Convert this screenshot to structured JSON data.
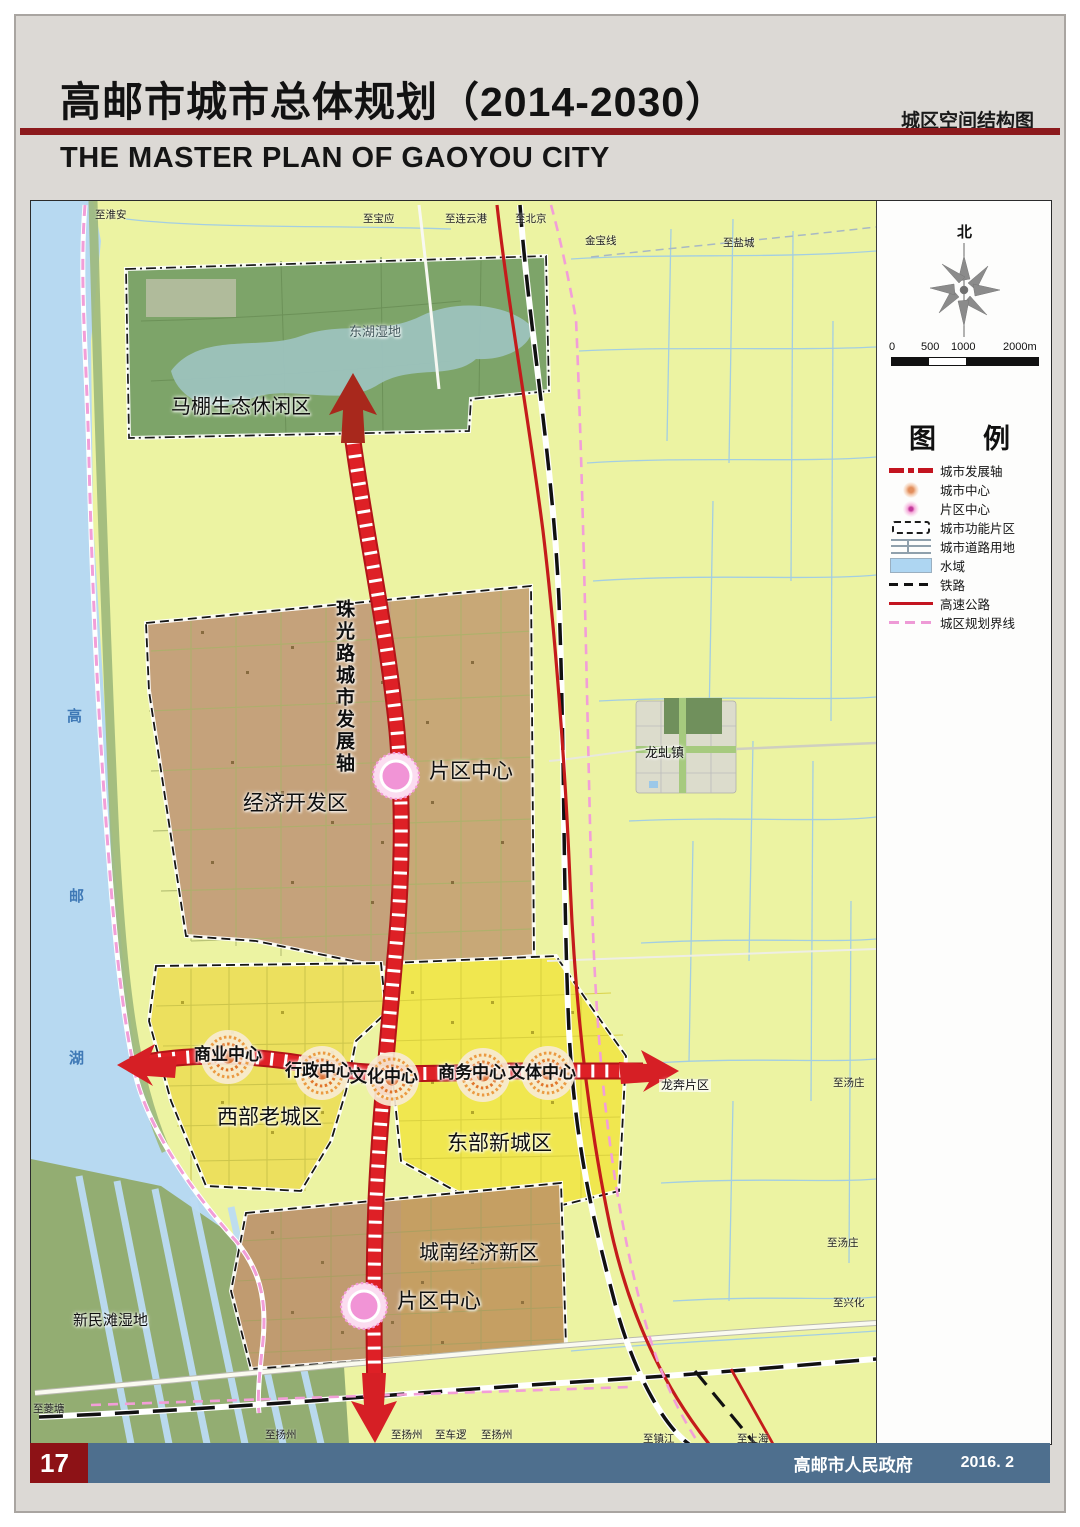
{
  "header": {
    "title": "高邮市城市总体规划（2014-2030）",
    "subtitle_en": "THE MASTER PLAN OF GAOYOU CITY",
    "map_type": "城区空间结构图"
  },
  "footer": {
    "page_number": "17",
    "publisher": "高邮市人民政府",
    "date": "2016. 2"
  },
  "compass": {
    "north_label": "北"
  },
  "scale_bar": {
    "ticks": [
      {
        "t": "0",
        "x": -2
      },
      {
        "t": "500",
        "x": 30
      },
      {
        "t": "1000",
        "x": 60
      },
      {
        "t": "2000m",
        "x": 112
      }
    ]
  },
  "legend": {
    "title": "图　例",
    "items": [
      {
        "label": "城市发展轴",
        "type": "axis"
      },
      {
        "label": "城市中心",
        "type": "city-center"
      },
      {
        "label": "片区中心",
        "type": "district-center"
      },
      {
        "label": "城市功能片区",
        "type": "func-zone"
      },
      {
        "label": "城市道路用地",
        "type": "road-land"
      },
      {
        "label": "水域",
        "type": "water"
      },
      {
        "label": "铁路",
        "type": "railway"
      },
      {
        "label": "高速公路",
        "type": "highway"
      },
      {
        "label": "城区规划界线",
        "type": "boundary"
      }
    ]
  },
  "map": {
    "zone_labels": [
      {
        "t": "马棚生态休闲区",
        "x": 140,
        "y": 196,
        "s": 20,
        "cls": ""
      },
      {
        "t": "东湖湿地",
        "x": 318,
        "y": 124,
        "s": 13,
        "cls": "dim"
      },
      {
        "t": "经济开发区",
        "x": 212,
        "y": 592,
        "s": 21,
        "cls": ""
      },
      {
        "t": "珠光路城市发展轴",
        "x": 302,
        "y": 398,
        "s": 19,
        "cls": "v"
      },
      {
        "t": "片区中心",
        "x": 398,
        "y": 560,
        "s": 21,
        "cls": ""
      },
      {
        "t": "商业中心",
        "x": 163,
        "y": 845,
        "s": 17,
        "cls": "c"
      },
      {
        "t": "行政中心",
        "x": 254,
        "y": 861,
        "s": 17,
        "cls": "c"
      },
      {
        "t": "文化中心",
        "x": 319,
        "y": 867,
        "s": 17,
        "cls": "c"
      },
      {
        "t": "商务中心",
        "x": 407,
        "y": 863,
        "s": 17,
        "cls": "c"
      },
      {
        "t": "文体中心",
        "x": 477,
        "y": 863,
        "s": 17,
        "cls": "c"
      },
      {
        "t": "西部老城区",
        "x": 186,
        "y": 906,
        "s": 21,
        "cls": ""
      },
      {
        "t": "东部新城区",
        "x": 416,
        "y": 932,
        "s": 21,
        "cls": ""
      },
      {
        "t": "城南经济新区",
        "x": 388,
        "y": 1042,
        "s": 20,
        "cls": ""
      },
      {
        "t": "片区中心",
        "x": 366,
        "y": 1090,
        "s": 21,
        "cls": ""
      },
      {
        "t": "新民滩湿地",
        "x": 42,
        "y": 1112,
        "s": 15,
        "cls": ""
      },
      {
        "t": "龙虬镇",
        "x": 614,
        "y": 545,
        "s": 13,
        "cls": ""
      },
      {
        "t": "龙奔片区",
        "x": 628,
        "y": 878,
        "s": 12,
        "cls": "bg"
      },
      {
        "t": "高",
        "x": 36,
        "y": 508,
        "s": 15,
        "cls": "lake"
      },
      {
        "t": "邮",
        "x": 38,
        "y": 688,
        "s": 15,
        "cls": "lake"
      },
      {
        "t": "湖",
        "x": 38,
        "y": 850,
        "s": 15,
        "cls": "lake"
      }
    ],
    "edge_labels": [
      {
        "t": "至淮安",
        "x": 64,
        "y": 6
      },
      {
        "t": "至宝应",
        "x": 332,
        "y": 10
      },
      {
        "t": "至连云港",
        "x": 414,
        "y": 10
      },
      {
        "t": "至北京",
        "x": 484,
        "y": 10
      },
      {
        "t": "金宝线",
        "x": 554,
        "y": 32
      },
      {
        "t": "至盐城",
        "x": 692,
        "y": 34
      },
      {
        "t": "至汤庄",
        "x": 802,
        "y": 874
      },
      {
        "t": "至汤庄",
        "x": 796,
        "y": 1034
      },
      {
        "t": "至兴化",
        "x": 802,
        "y": 1094
      },
      {
        "t": "至菱塘",
        "x": 2,
        "y": 1200
      },
      {
        "t": "至扬州",
        "x": 234,
        "y": 1226
      },
      {
        "t": "至扬州",
        "x": 360,
        "y": 1226
      },
      {
        "t": "至车逻",
        "x": 404,
        "y": 1226
      },
      {
        "t": "至扬州",
        "x": 450,
        "y": 1226
      },
      {
        "t": "至镇江",
        "x": 612,
        "y": 1230
      },
      {
        "t": "至上海",
        "x": 706,
        "y": 1230
      }
    ]
  },
  "colors": {
    "header_rule": "#8c1a1d",
    "axis_red": "#de2026",
    "highway_red": "#c3141f",
    "water_blue": "#b7d9f1",
    "background_green": "#ecf3a2",
    "eco_green": "#7da469",
    "dev_brown": "#c8a877",
    "oldtown_yellow": "#ece05e",
    "newtown_yellow": "#f0e74f",
    "south_tan": "#c59f63",
    "boundary_pink": "#f29ed8",
    "footer_blue": "#4e6f8e",
    "pagenum_red": "#8d1216",
    "district_center_pink": "#f194d6"
  }
}
